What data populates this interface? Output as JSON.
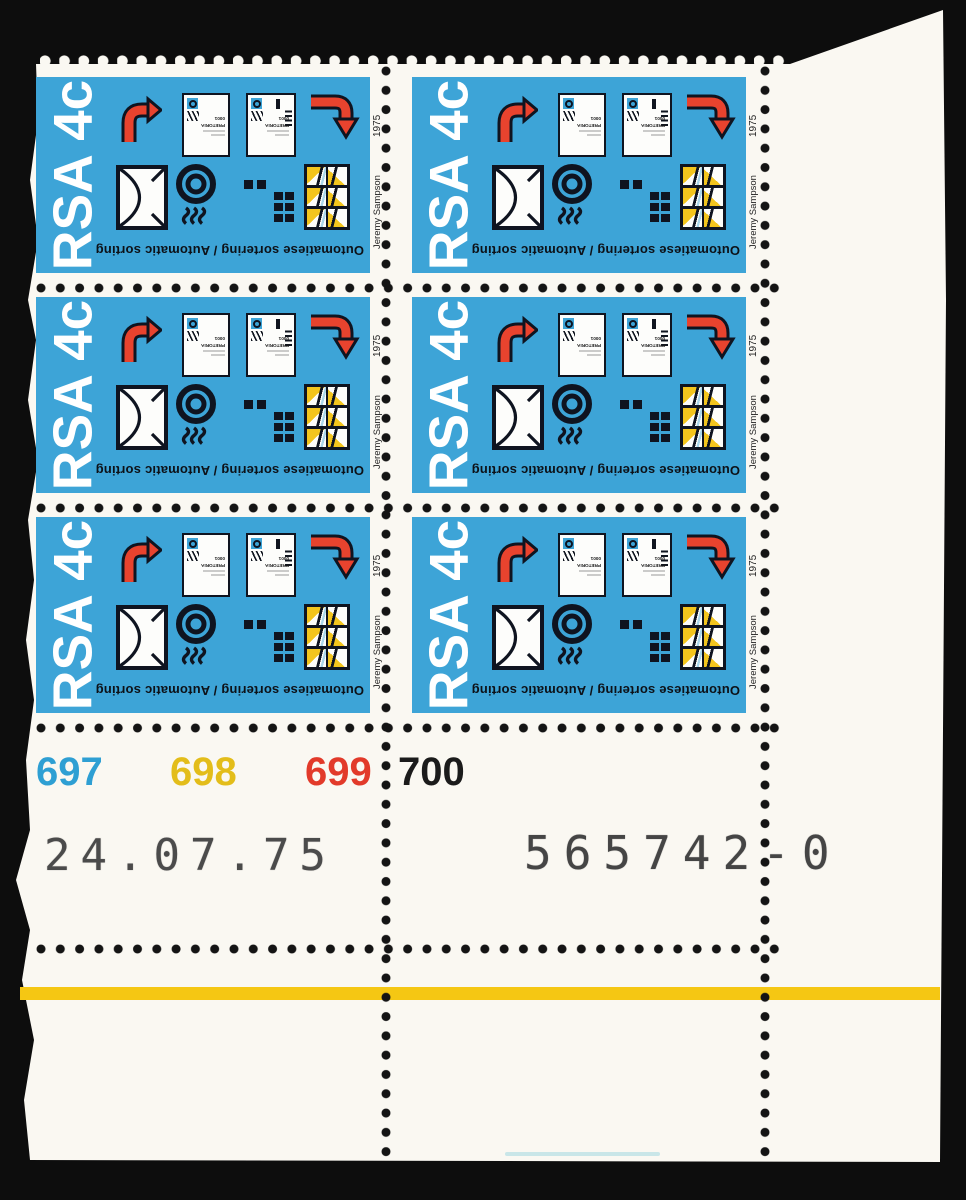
{
  "stamp": {
    "denomination": "RSA 4c",
    "caption": "Outomatiese sortering / Automatic sorting",
    "year": "1975",
    "designer": "Jeremy Sampson",
    "envelope": {
      "city": "PRETORIA",
      "postal_code": "0001"
    }
  },
  "sheet": {
    "plate_numbers": [
      {
        "value": "697",
        "color": "#2e9fd3"
      },
      {
        "value": "698",
        "color": "#e3bd1a"
      },
      {
        "value": "699",
        "color": "#e23a2a"
      },
      {
        "value": "700",
        "color": "#1b1b1b"
      }
    ],
    "date_stamp": "24.07.75",
    "control_number": "565742-0",
    "accent_colors": {
      "stamp_blue": "#3da4d7",
      "arrow_red": "#e8432e",
      "band_yellow": "#f5c713"
    }
  }
}
